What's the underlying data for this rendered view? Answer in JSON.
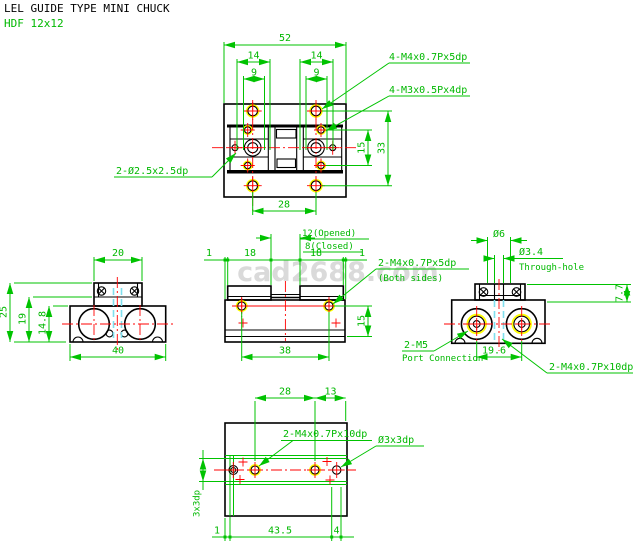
{
  "header": {
    "title": "LEL GUIDE TYPE MINI CHUCK",
    "model": "HDF 12x12"
  },
  "watermark": {
    "text": "cad2688.com"
  },
  "colors": {
    "dimension": "#00c300",
    "centerline": "#ff0000",
    "geometry": "#000000",
    "hidden_line": "#7fdfee",
    "hole_highlight": "#ffff00",
    "watermark": "#dadada"
  },
  "top": {
    "dim_width": "52",
    "dim_pitch_left": "14",
    "dim_pitch_right": "14",
    "dim_inner_left": "9",
    "dim_inner_right": "9",
    "dim_row_spacing": "15",
    "dim_height": "33",
    "dim_bottom_pitch": "28",
    "label_m4": "4-M4x0.7Px5dp",
    "label_m3": "4-M3x0.5Px4dp",
    "label_pin": "2-Ø2.5x2.5dp"
  },
  "front": {
    "dim_edge_left": "1",
    "dim_jaw_left": "18",
    "dim_jaw_right": "18",
    "dim_edge_right": "1",
    "dim_opened": "12(Opened)",
    "dim_closed": "8(Closed)",
    "dim_screw_depth": "15",
    "dim_screw_pitch": "38",
    "label_m4": "2-M4x0.7Px5dp",
    "label_m4_note": "(Both sides)"
  },
  "left": {
    "dim_jaw_width": "20",
    "dim_total_height": "25",
    "dim_height_19": "19",
    "dim_height_14_8": "14.8",
    "dim_body_width": "40"
  },
  "right": {
    "dim_boss": "Ø6",
    "dim_through": "Ø3.4",
    "label_through": "Through-hole",
    "dim_step": "7.7",
    "dim_port_pitch": "19.6",
    "label_port": "2-M5",
    "label_port_note": "Port Connection",
    "label_m4": "2-M4x0.7Px10dp"
  },
  "bottom": {
    "dim_pitch": "28",
    "dim_offset": "13",
    "label_m4": "2-M4x0.7Px10dp",
    "label_pin": "Ø3x3dp",
    "label_pin_side": "3x3dp",
    "dim_edge": "1",
    "dim_length": "43.5",
    "dim_end": "4"
  }
}
